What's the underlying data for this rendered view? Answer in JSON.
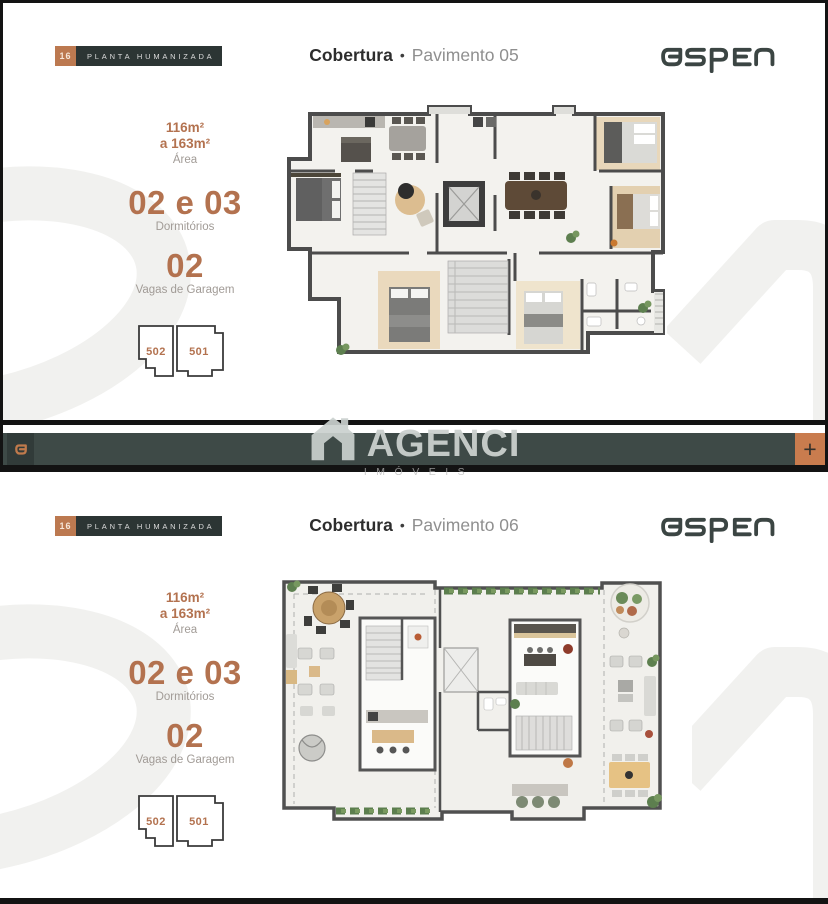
{
  "brand": {
    "logo_text": "aspen",
    "colors": {
      "accent": "#b3724f",
      "tag_orange": "#bc7950",
      "bar_slate": "#3e4a47",
      "bar_orange": "#c97c4e",
      "logo_dark": "#3b4543"
    }
  },
  "watermark": {
    "brand": "AGENCI",
    "subtitle": "IMÓVEIS",
    "background_word": "aspen"
  },
  "divider": {
    "left_mark": "a",
    "plus_label": "+"
  },
  "sections": [
    {
      "tag": {
        "number": "16",
        "label": "PLANTA HUMANIZADA"
      },
      "title": {
        "bold": "Cobertura",
        "separator": "•",
        "regular": "Pavimento 05"
      },
      "stats": {
        "area_line1": "116m²",
        "area_line2": "a 163m²",
        "area_label": "Área",
        "dorms_value": "02 e 03",
        "dorms_label": "Dormitórios",
        "garage_value": "02",
        "garage_label": "Vagas de Garagem"
      },
      "units": [
        {
          "number": "502"
        },
        {
          "number": "501"
        }
      ]
    },
    {
      "tag": {
        "number": "16",
        "label": "PLANTA HUMANIZADA"
      },
      "title": {
        "bold": "Cobertura",
        "separator": "•",
        "regular": "Pavimento 06"
      },
      "stats": {
        "area_line1": "116m²",
        "area_line2": "a 163m²",
        "area_label": "Área",
        "dorms_value": "02 e 03",
        "dorms_label": "Dormitórios",
        "garage_value": "02",
        "garage_label": "Vagas de Garagem"
      },
      "units": [
        {
          "number": "502"
        },
        {
          "number": "501"
        }
      ]
    }
  ]
}
